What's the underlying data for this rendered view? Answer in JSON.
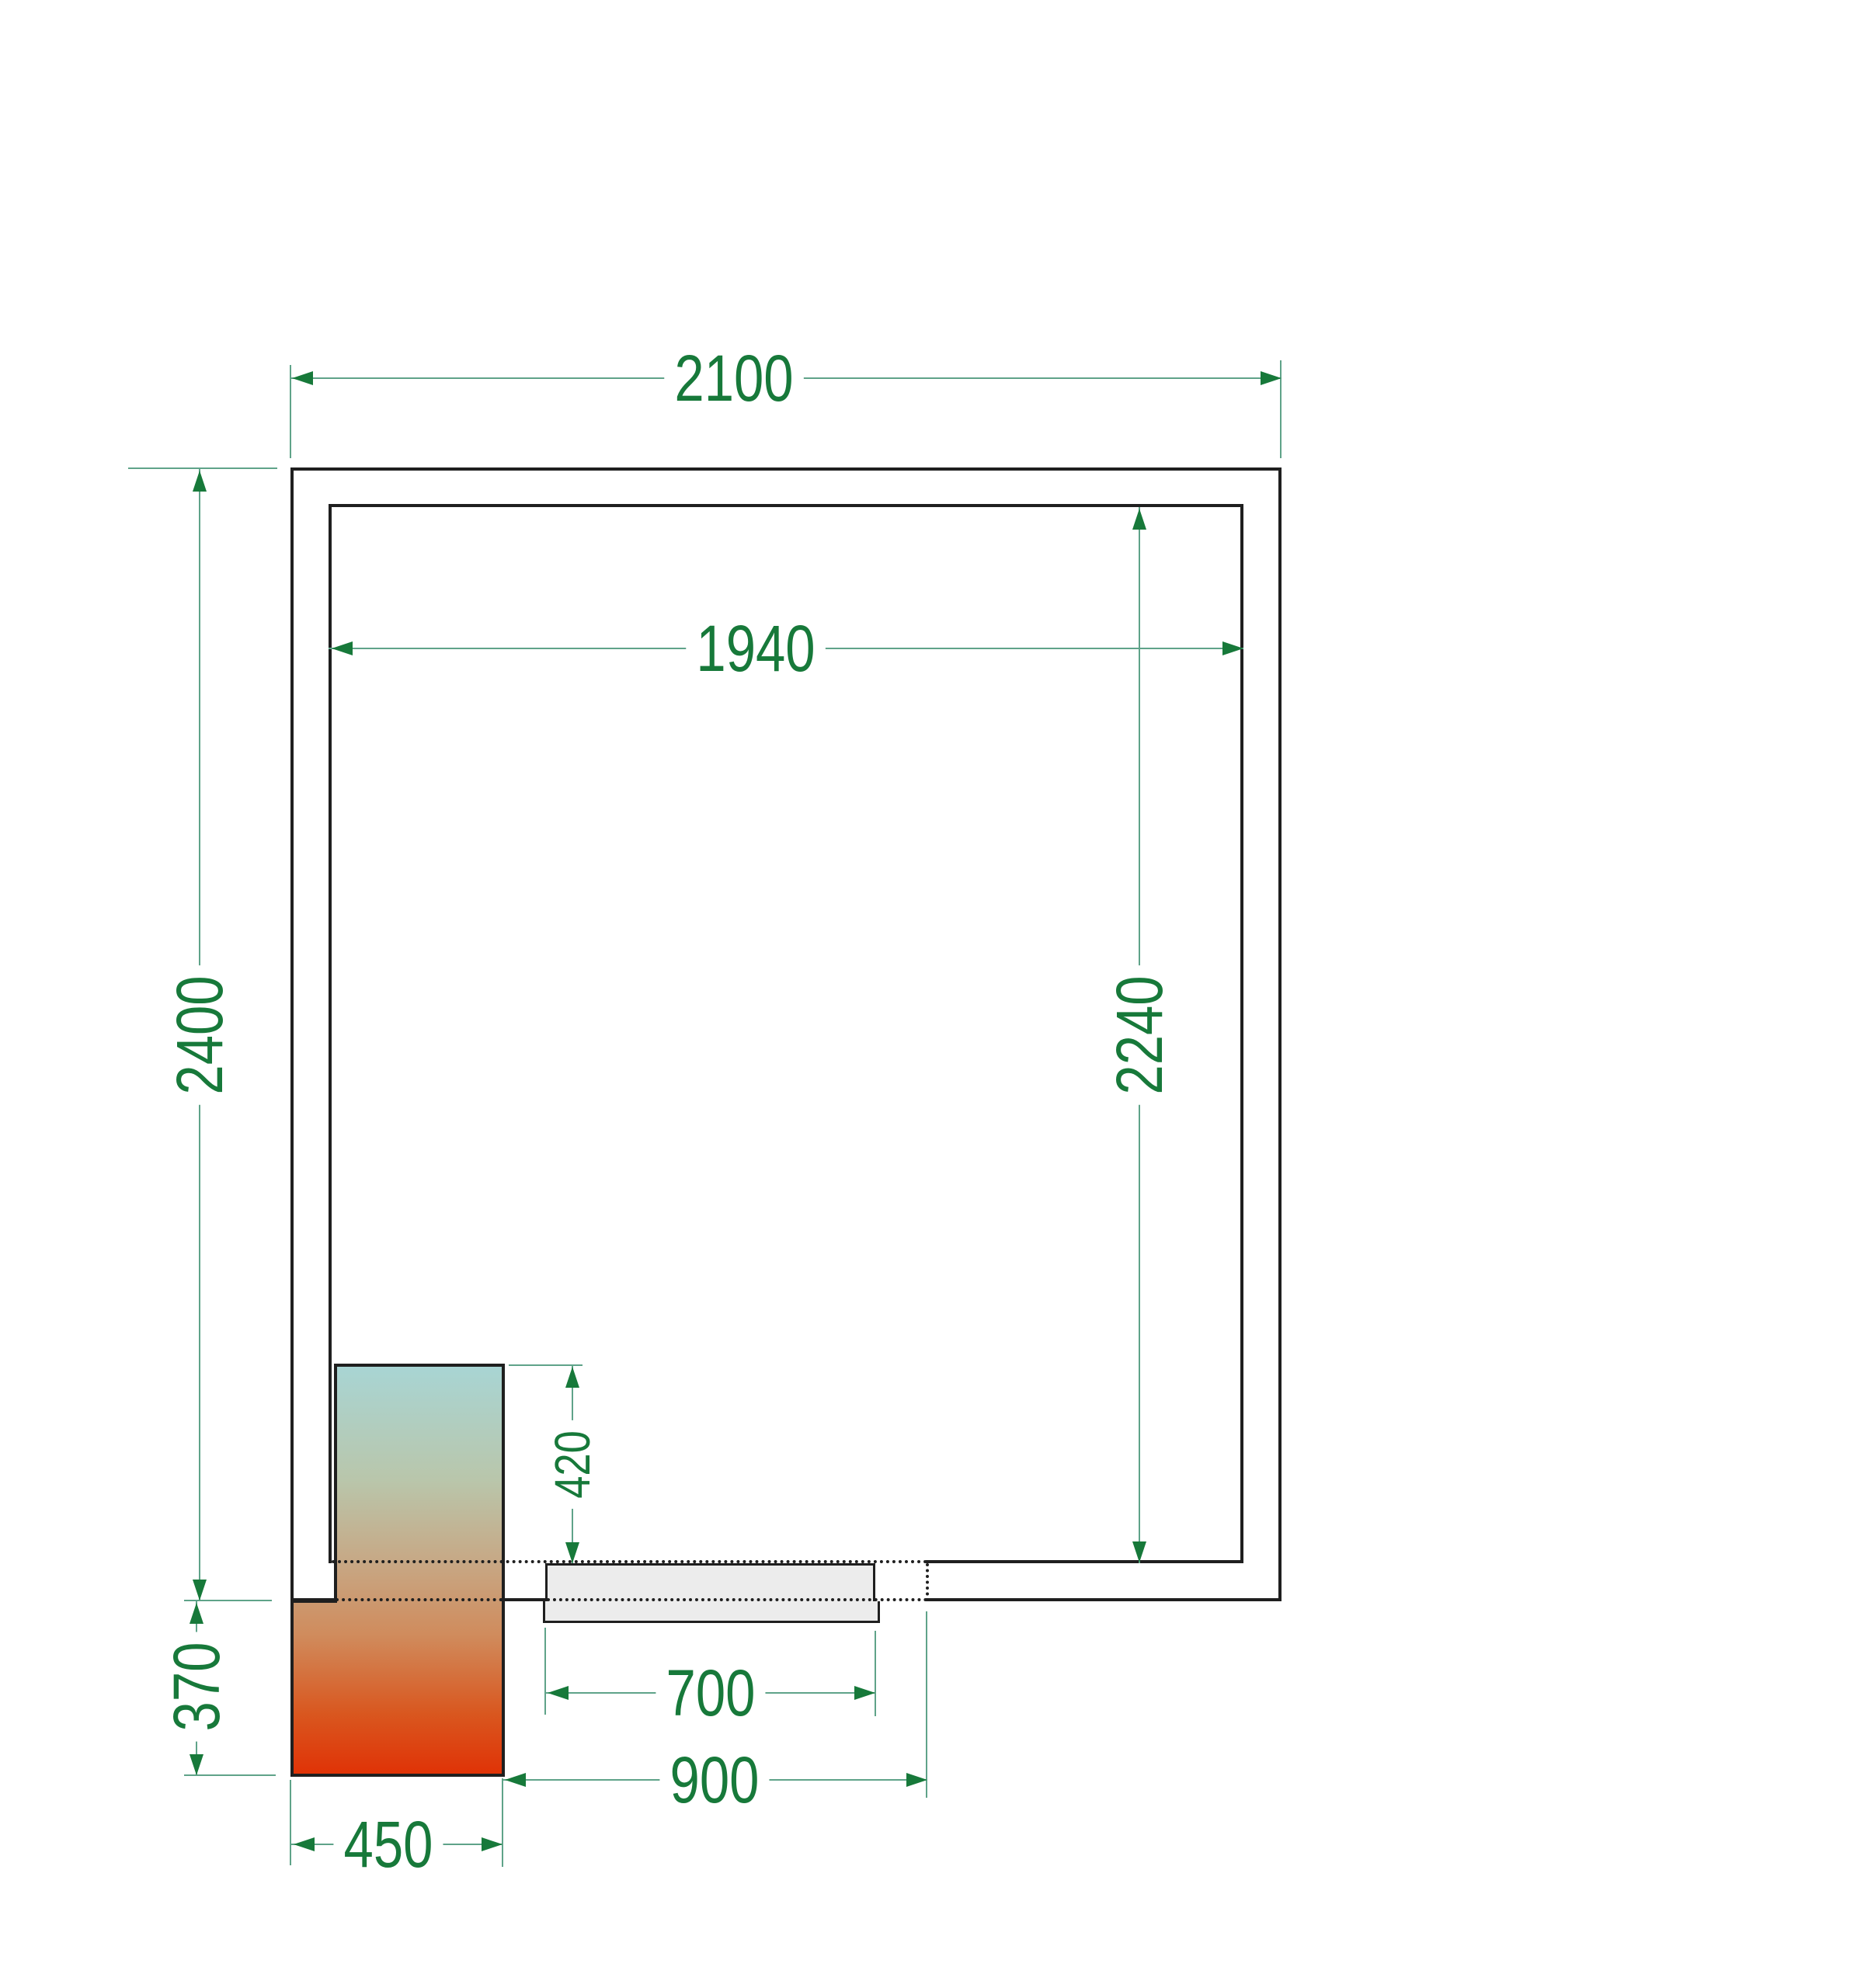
{
  "drawing": {
    "type": "cold-room floor plan",
    "dimensions": {
      "outer_width": "2100",
      "inner_width": "1940",
      "outer_height": "2400",
      "inner_height": "2240",
      "unit_depth_inside": "420",
      "unit_depth_outside": "370",
      "door_width": "700",
      "door_opening_span": "900",
      "unit_width": "450"
    },
    "colors": {
      "dimension_text": "#17793a",
      "dimension_line": "#5fa389",
      "wall_line": "#1f1f1f",
      "door_fill": "#ececec",
      "unit_gradient_top": "#a8d5d4",
      "unit_gradient_middle": "#c7a885",
      "unit_gradient_bottom": "#e03206"
    }
  }
}
